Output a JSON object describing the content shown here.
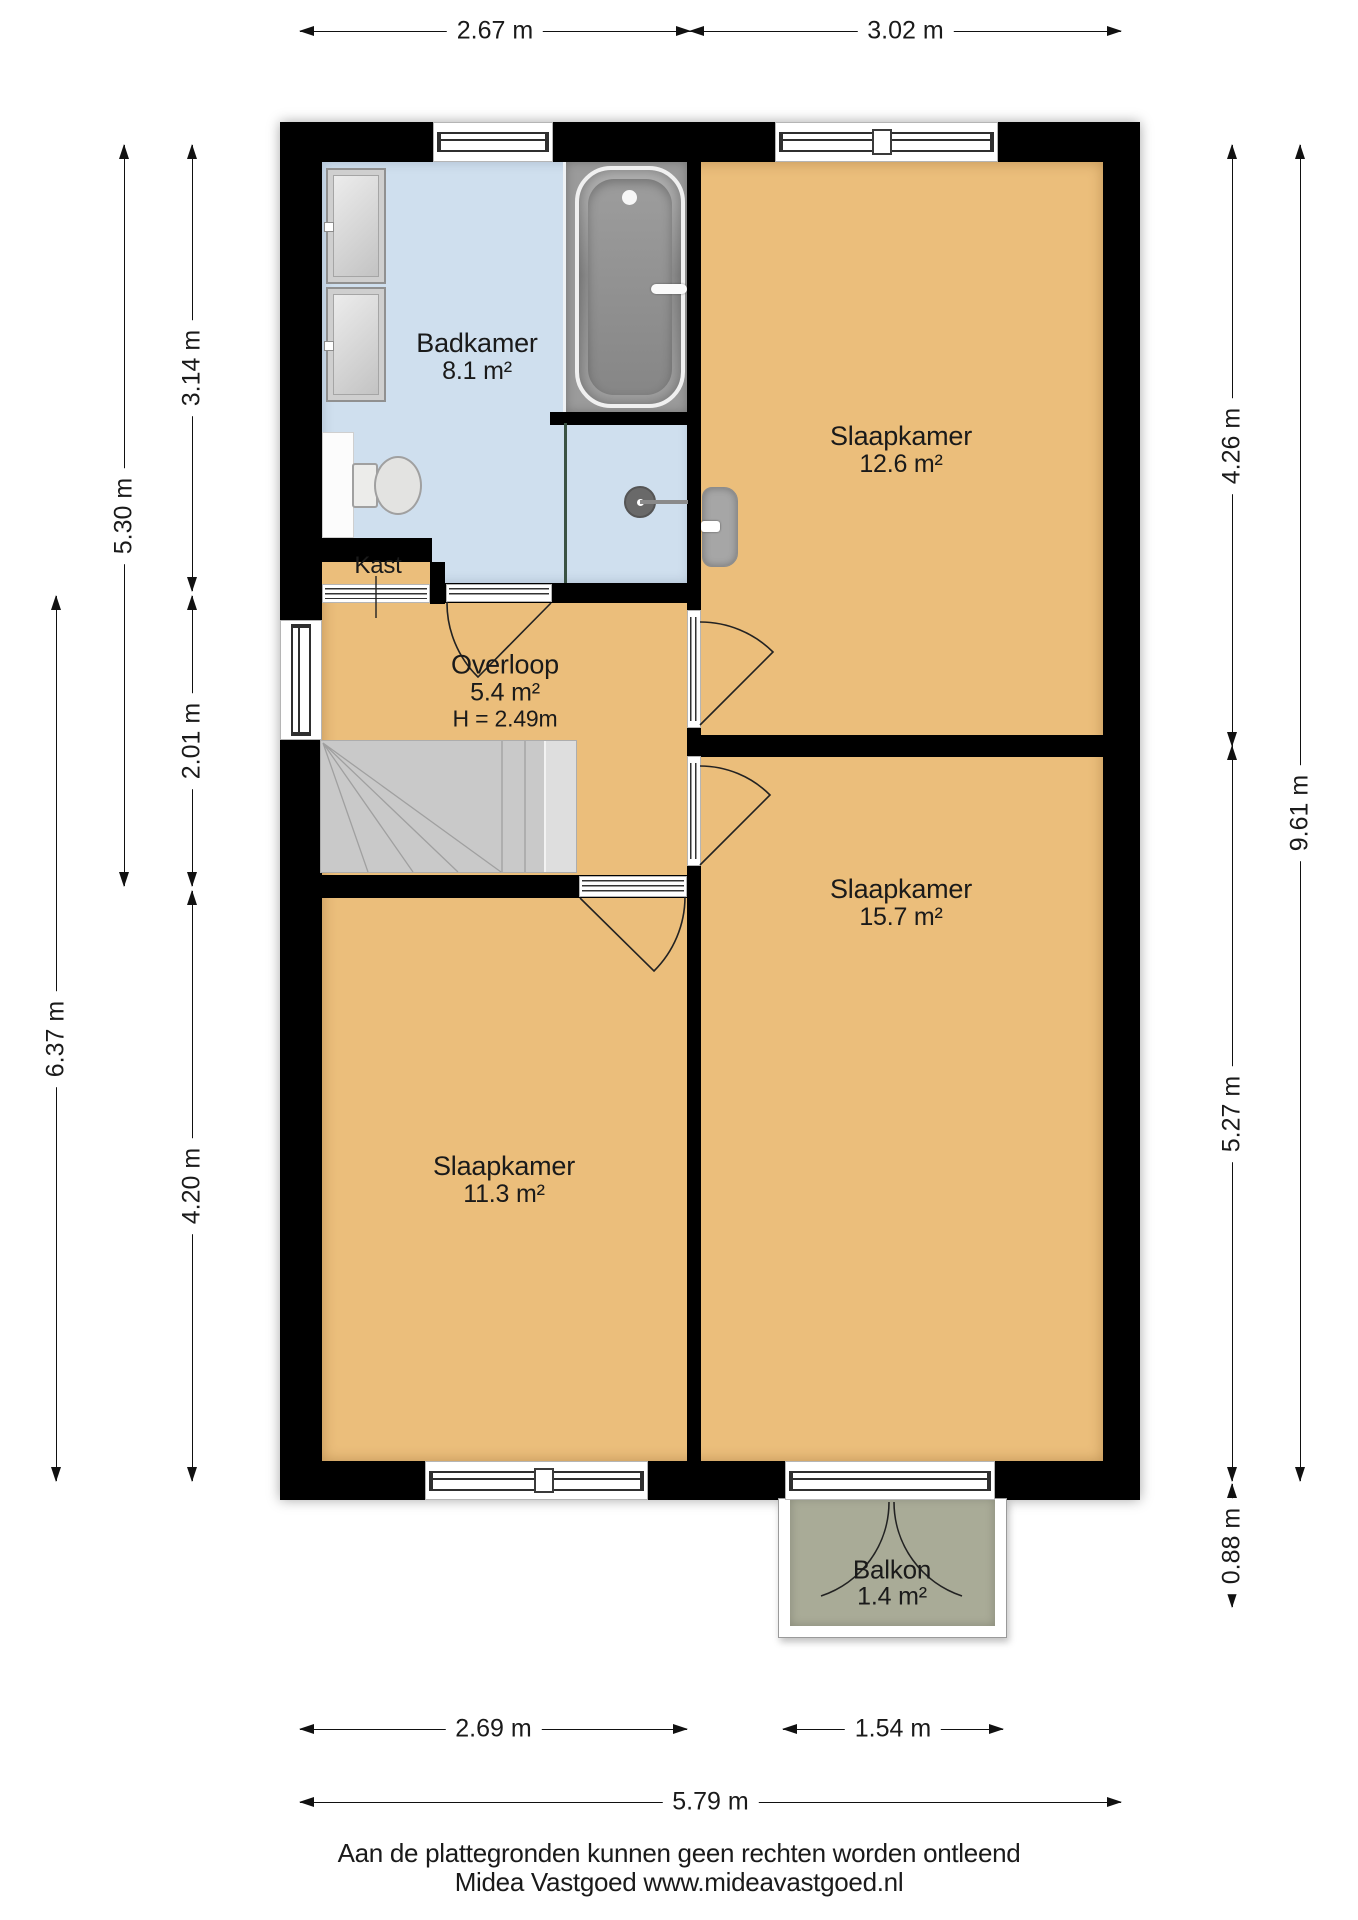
{
  "rooms": {
    "badkamer": {
      "name": "Badkamer",
      "area": "8.1 m²"
    },
    "slaapkamer_1": {
      "name": "Slaapkamer",
      "area": "12.6 m²"
    },
    "kast": {
      "name": "Kast"
    },
    "overloop": {
      "name": "Overloop",
      "area": "5.4 m²",
      "ceiling_height": "H = 2.49m"
    },
    "slaapkamer_2": {
      "name": "Slaapkamer",
      "area": "11.3 m²"
    },
    "slaapkamer_3": {
      "name": "Slaapkamer",
      "area": "15.7 m²"
    },
    "balkon": {
      "name": "Balkon",
      "area": "1.4 m²"
    }
  },
  "dimensions": {
    "top": [
      "2.67 m",
      "3.02 m"
    ],
    "bottom": [
      "2.69 m",
      "1.54 m"
    ],
    "bottom_total": "5.79 m",
    "left_inner": [
      "3.14 m",
      "2.01 m",
      "4.20 m"
    ],
    "left_outer": [
      "5.30 m",
      "6.37 m"
    ],
    "right_inner": [
      "4.26 m",
      "5.27 m",
      "0.88 m"
    ],
    "right_outer": "9.61 m"
  },
  "footer": {
    "disclaimer": "Aan de plattegronden kunnen geen rechten worden ontleend",
    "agency": "Midea Vastgoed www.mideavastgoed.nl"
  },
  "colors": {
    "wall": "#000000",
    "floor_room": "#ebbe7b",
    "floor_bathroom": "#cfdfee",
    "wet_zone": "#9b9b9b",
    "balcony_floor": "#a9ab97",
    "stairs": "#c9c9c9"
  }
}
